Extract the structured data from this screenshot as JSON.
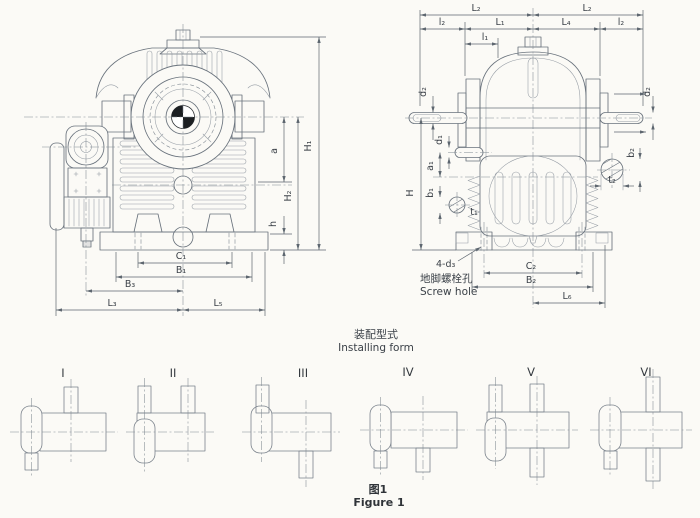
{
  "colors": {
    "line": "#6a737d",
    "text": "#3b4148",
    "background": "#fbfaf6",
    "solid_mark": "#1c1f22"
  },
  "figure": {
    "caption_cn": "图1",
    "caption_en": "Figure 1"
  },
  "front_view": {
    "dims": {
      "H1": "H₁",
      "H2": "H₂",
      "a": "a",
      "h": "h",
      "C1": "C₁",
      "B1": "B₁",
      "B3": "B₃",
      "L3": "L₃",
      "L5": "L₅"
    }
  },
  "side_view": {
    "dims": {
      "L2": "L₂",
      "l2": "l₂",
      "L1": "L₁",
      "L4": "L₄",
      "l1": "l₁",
      "d2": "d₂",
      "d1": "d₁",
      "a1": "a₁",
      "b1": "b₁",
      "t1": "t₁",
      "H": "H",
      "b2": "b₂",
      "t2": "t₂",
      "C2": "C₂",
      "B2": "B₂",
      "L6": "L₆",
      "bolt_holes": "4-d₃"
    },
    "screw_hole_cn": "地脚螺栓孔",
    "screw_hole_en": "Screw hole"
  },
  "installing_form": {
    "title_cn": "装配型式",
    "title_en": "Installing form",
    "forms": [
      {
        "numeral": "I"
      },
      {
        "numeral": "II"
      },
      {
        "numeral": "III"
      },
      {
        "numeral": "IV"
      },
      {
        "numeral": "V"
      },
      {
        "numeral": "VI"
      }
    ]
  }
}
